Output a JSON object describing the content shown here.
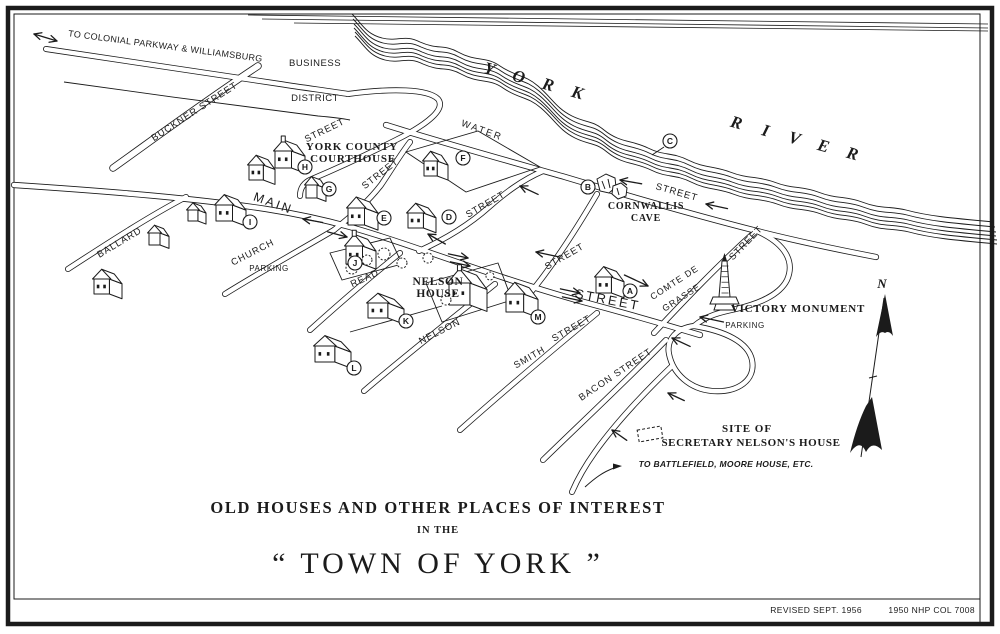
{
  "page": {
    "ink": "#1b1b1b",
    "paper": "#ffffff"
  },
  "credits": {
    "revised": "REVISED SEPT. 1956",
    "catalog": "1950  NHP  COL  7008"
  },
  "title_block": {
    "line1": "OLD HOUSES AND OTHER PLACES OF INTEREST",
    "line2": "IN THE",
    "line3": "“ TOWN OF YORK ”"
  },
  "compass": {
    "label": "N",
    "x": 882,
    "y": 288
  },
  "river": {
    "word1": "YORK",
    "w1x1": 488,
    "w1y1": 74,
    "w1x2": 576,
    "w1y2": 98,
    "word2": "RIVER",
    "w2x1": 735,
    "w2y1": 128,
    "w2x2": 851,
    "w2y2": 159,
    "rot": 16
  },
  "labels": [
    {
      "id": "to-parkway",
      "text": "TO COLONIAL PARKWAY & WILLIAMSBURG",
      "x": 165,
      "y": 49,
      "r": 7.5,
      "s": 9,
      "f": "sans",
      "sp": 0.3
    },
    {
      "id": "business",
      "text": "BUSINESS",
      "x": 315,
      "y": 66,
      "r": 0,
      "s": 9.5,
      "f": "sans",
      "sp": 0.5
    },
    {
      "id": "district",
      "text": "DISTRICT",
      "x": 315,
      "y": 101,
      "r": 0,
      "s": 9.5,
      "f": "sans",
      "sp": 0.5
    },
    {
      "id": "buckner-street",
      "text": "BUCKNER  STREET",
      "x": 196,
      "y": 114,
      "r": -33,
      "s": 9.5,
      "f": "sans",
      "sp": 1
    },
    {
      "id": "street-loop",
      "text": "STREET",
      "x": 326,
      "y": 133,
      "r": -26,
      "s": 9.5,
      "f": "sans",
      "sp": 1
    },
    {
      "id": "water-street",
      "text": "WATER",
      "x": 481,
      "y": 133,
      "r": 20,
      "s": 9.5,
      "f": "sans",
      "sp": 2
    },
    {
      "id": "york-county",
      "text": "YORK COUNTY",
      "x": 352,
      "y": 150,
      "r": 0,
      "s": 11,
      "f": "serif",
      "sp": 0.8,
      "b": true
    },
    {
      "id": "courthouse",
      "text": "COURTHOUSE",
      "x": 353,
      "y": 162,
      "r": 0,
      "s": 11,
      "f": "serif",
      "sp": 0.8,
      "b": true
    },
    {
      "id": "street-church-upper",
      "text": "STREET",
      "x": 382,
      "y": 176,
      "r": -38,
      "s": 9.5,
      "f": "sans",
      "sp": 1
    },
    {
      "id": "main-street",
      "text": "MAIN",
      "x": 272,
      "y": 207,
      "r": 20,
      "s": 12.5,
      "f": "sans",
      "sp": 2.5
    },
    {
      "id": "church-street",
      "text": "CHURCH",
      "x": 254,
      "y": 255,
      "r": -27,
      "s": 9.5,
      "f": "sans",
      "sp": 1
    },
    {
      "id": "parking-church",
      "text": "PARKING",
      "x": 269,
      "y": 271,
      "r": 0,
      "s": 8,
      "f": "sans",
      "sp": 0.6
    },
    {
      "id": "street-connector",
      "text": "STREET",
      "x": 487,
      "y": 207,
      "r": -30,
      "s": 9.5,
      "f": "sans",
      "sp": 1
    },
    {
      "id": "street-water-east",
      "text": "STREET",
      "x": 676,
      "y": 195,
      "r": 16,
      "s": 9.5,
      "f": "sans",
      "sp": 1
    },
    {
      "id": "cornwallis",
      "text": "CORNWALLIS",
      "x": 646,
      "y": 209,
      "r": 0,
      "s": 10,
      "f": "serif",
      "sp": 0.8,
      "b": true
    },
    {
      "id": "cave",
      "text": "CAVE",
      "x": 646,
      "y": 221,
      "r": 0,
      "s": 10,
      "f": "serif",
      "sp": 0.8,
      "b": true
    },
    {
      "id": "read-street",
      "text": "READ",
      "x": 366,
      "y": 281,
      "r": -25,
      "s": 9.5,
      "f": "sans",
      "sp": 1
    },
    {
      "id": "nelson-house-1",
      "text": "NELSON",
      "x": 438,
      "y": 285,
      "r": 0,
      "s": 11.5,
      "f": "serif",
      "sp": 0.6,
      "b": true
    },
    {
      "id": "nelson-house-2",
      "text": "HOUSE",
      "x": 438,
      "y": 297,
      "r": 0,
      "s": 11.5,
      "f": "serif",
      "sp": 0.6,
      "b": true
    },
    {
      "id": "nelson-street",
      "text": "NELSON",
      "x": 441,
      "y": 334,
      "r": -27,
      "s": 9.5,
      "f": "sans",
      "sp": 1
    },
    {
      "id": "street-m",
      "text": "STREET",
      "x": 566,
      "y": 259,
      "r": -30,
      "s": 9.5,
      "f": "sans",
      "sp": 1
    },
    {
      "id": "main-street-2",
      "text": "STREET",
      "x": 607,
      "y": 304,
      "r": 11,
      "s": 13,
      "f": "sans",
      "sp": 2.5
    },
    {
      "id": "smith-street",
      "text": "SMITH",
      "x": 531,
      "y": 360,
      "r": -30,
      "s": 9.5,
      "f": "sans",
      "sp": 1
    },
    {
      "id": "street-smith",
      "text": "STREET",
      "x": 573,
      "y": 331,
      "r": -30,
      "s": 9.5,
      "f": "sans",
      "sp": 1
    },
    {
      "id": "bacon-street",
      "text": "BACON  STREET",
      "x": 617,
      "y": 377,
      "r": -34,
      "s": 9.5,
      "f": "sans",
      "sp": 1
    },
    {
      "id": "comte-de",
      "text": "COMTE  DE",
      "x": 676,
      "y": 285,
      "r": -33,
      "s": 9,
      "f": "sans",
      "sp": 1
    },
    {
      "id": "grasse",
      "text": "GRASSE",
      "x": 683,
      "y": 300,
      "r": -33,
      "s": 9,
      "f": "sans",
      "sp": 1
    },
    {
      "id": "street-comte",
      "text": "STREET",
      "x": 748,
      "y": 245,
      "r": -46,
      "s": 9.5,
      "f": "sans",
      "sp": 1
    },
    {
      "id": "victory-monument",
      "text": "VICTORY  MONUMENT",
      "x": 798,
      "y": 312,
      "r": 0,
      "s": 11,
      "f": "serif",
      "sp": 0.8,
      "b": true
    },
    {
      "id": "parking-victory",
      "text": "PARKING",
      "x": 745,
      "y": 328,
      "r": 0,
      "s": 8,
      "f": "sans",
      "sp": 0.6
    },
    {
      "id": "site-of",
      "text": "SITE  OF",
      "x": 747,
      "y": 432,
      "r": 0,
      "s": 11,
      "f": "serif",
      "sp": 1,
      "b": true
    },
    {
      "id": "secretary-nelson",
      "text": "SECRETARY  NELSON'S  HOUSE",
      "x": 751,
      "y": 446,
      "r": 0,
      "s": 11,
      "f": "serif",
      "sp": 0.6,
      "b": true
    },
    {
      "id": "to-battlefield",
      "text": "TO BATTLEFIELD, MOORE HOUSE, ETC.",
      "x": 726,
      "y": 467,
      "r": 0,
      "s": 8.5,
      "f": "sans",
      "sp": 0.3,
      "b": true,
      "i": true
    },
    {
      "id": "ballard-street",
      "text": "BALLARD",
      "x": 121,
      "y": 245,
      "r": -31,
      "s": 9.5,
      "f": "sans",
      "sp": 1
    }
  ],
  "markers": [
    {
      "letter": "A",
      "x": 630,
      "y": 291
    },
    {
      "letter": "B",
      "x": 588,
      "y": 187
    },
    {
      "letter": "C",
      "x": 670,
      "y": 141
    },
    {
      "letter": "D",
      "x": 449,
      "y": 217
    },
    {
      "letter": "E",
      "x": 384,
      "y": 218
    },
    {
      "letter": "F",
      "x": 463,
      "y": 158
    },
    {
      "letter": "G",
      "x": 329,
      "y": 189
    },
    {
      "letter": "H",
      "x": 305,
      "y": 167
    },
    {
      "letter": "I",
      "x": 250,
      "y": 222
    },
    {
      "letter": "J",
      "x": 355,
      "y": 263
    },
    {
      "letter": "K",
      "x": 406,
      "y": 321
    },
    {
      "letter": "L",
      "x": 354,
      "y": 368
    },
    {
      "letter": "M",
      "x": 538,
      "y": 317
    }
  ],
  "roads": [
    {
      "id": "main-street",
      "w": 6.2,
      "d": "M14,185 C120,192 200,199 266,209 C330,219 370,232 428,252 C480,270 530,287 580,301 C625,313 660,323 700,335"
    },
    {
      "id": "water-street",
      "w": 6.2,
      "d": "M386,125 C440,142 505,160 565,177 C625,195 690,214 757,231 C800,242 840,250 876,257"
    },
    {
      "id": "parkway",
      "w": 6,
      "d": "M46,49 C120,60 200,72 280,84 C305,88 330,91 348,94"
    },
    {
      "id": "business-loop",
      "w": 6,
      "d": "M348,94 C392,88 428,89 438,99 C446,109 428,124 396,140 C368,154 338,168 312,179 C302,183 300,190 300,196"
    },
    {
      "id": "buckner-road",
      "w": 7.5,
      "d": "M113,168 C155,138 205,101 258,66"
    },
    {
      "id": "ballard-road",
      "w": 6,
      "d": "M68,269 C108,243 148,217 186,197"
    },
    {
      "id": "church-lower",
      "w": 6,
      "d": "M225,294 C262,271 300,250 334,230"
    },
    {
      "id": "church-upper",
      "w": 6,
      "d": "M334,230 C352,216 368,202 381,185 C390,172 398,158 410,142"
    },
    {
      "id": "read-road",
      "w": 6,
      "d": "M310,330 C340,303 370,277 400,253"
    },
    {
      "id": "nelson-road",
      "w": 6,
      "d": "M364,391 C400,360 448,322 495,284"
    },
    {
      "id": "smith-road",
      "w": 6,
      "d": "M460,430 C505,390 550,352 597,313"
    },
    {
      "id": "bacon-road",
      "w": 6,
      "d": "M543,460 C580,424 625,382 666,340"
    },
    {
      "id": "comte-road",
      "w": 6,
      "d": "M654,333 C684,301 718,265 756,231"
    },
    {
      "id": "m-water-connector",
      "w": 6,
      "d": "M527,297 C548,272 570,240 597,194"
    },
    {
      "id": "main-water-connector",
      "w": 6,
      "d": "M419,251 C448,238 470,224 489,207 C505,193 522,180 543,171"
    },
    {
      "id": "water-loop-spur",
      "w": 6,
      "d": "M757,231 C786,244 795,262 787,280 C779,296 757,304 736,309 C722,312 707,315 694,326"
    },
    {
      "id": "turn-loop",
      "w": 6,
      "d": "M694,326 C725,331 748,342 752,360 C756,380 738,393 712,391 C690,389 673,374 669,354 C666,339 677,328 694,326 Z"
    },
    {
      "id": "battlefield-exit",
      "w": 6,
      "d": "M672,366 C645,392 615,424 595,452 C585,466 578,478 572,492"
    }
  ],
  "road_lines": [
    {
      "id": "parkway-lower-edge",
      "d": "M64,82 C150,94 230,105 318,116 C330,117 340,118 350,120"
    }
  ],
  "blocks": [
    {
      "id": "courthouse-block",
      "d": "M406,152 L478,131 L540,167 L466,192 Z"
    },
    {
      "id": "j-lot",
      "d": "M330,253 L390,238 L402,264 L342,280 Z"
    },
    {
      "id": "nelson-lot",
      "d": "M426,283 L498,263 L512,300 L442,322 Z"
    },
    {
      "id": "k-lot-line",
      "d": "M350,332 L442,306"
    }
  ],
  "shoreline": {
    "base": "M352,14 C362,24 366,34 382,38 C398,42 404,34 420,42 C438,50 444,44 458,52 C476,62 486,56 500,66 C516,77 524,74 538,86 C552,98 556,108 572,116 C586,123 592,120 604,130 C620,143 632,140 648,148 C664,156 672,152 688,160 C704,168 714,166 730,172 C748,179 758,176 774,182 C792,189 802,186 818,192 C836,199 846,196 862,202 C880,209 890,206 906,210 C928,216 950,218 994,222",
    "offsets": [
      [
        0,
        0
      ],
      [
        1,
        5
      ],
      [
        2,
        10
      ],
      [
        2,
        14
      ],
      [
        3,
        18
      ],
      [
        3,
        22
      ]
    ],
    "far_edge": [
      "M248,15 C400,18 600,20 988,24",
      "M262,19 C420,22 620,24 988,28",
      "M294,23 C460,26 660,28 988,31"
    ]
  },
  "buildings": [
    {
      "id": "house-west-1",
      "x": 108,
      "y": 294,
      "w": 28,
      "h": 15
    },
    {
      "id": "house-west-2",
      "x": 159,
      "y": 245,
      "w": 20,
      "h": 12
    },
    {
      "id": "house-west-3",
      "x": 197,
      "y": 221,
      "w": 18,
      "h": 11
    },
    {
      "id": "i-house",
      "x": 231,
      "y": 221,
      "w": 30,
      "h": 16
    },
    {
      "id": "courthouse-wing",
      "x": 262,
      "y": 180,
      "w": 26,
      "h": 15
    },
    {
      "id": "courthouse-main",
      "x": 290,
      "y": 168,
      "w": 30,
      "h": 17,
      "c": true
    },
    {
      "id": "g-house",
      "x": 316,
      "y": 198,
      "w": 20,
      "h": 13
    },
    {
      "id": "e-house",
      "x": 363,
      "y": 225,
      "w": 30,
      "h": 17
    },
    {
      "id": "d-house",
      "x": 422,
      "y": 228,
      "w": 28,
      "h": 15
    },
    {
      "id": "f-house",
      "x": 436,
      "y": 176,
      "w": 24,
      "h": 15
    },
    {
      "id": "j-house",
      "x": 361,
      "y": 264,
      "w": 30,
      "h": 18,
      "c": true
    },
    {
      "id": "nelson-house",
      "x": 468,
      "y": 305,
      "w": 38,
      "h": 22,
      "c": true
    },
    {
      "id": "k-house",
      "x": 386,
      "y": 318,
      "w": 36,
      "h": 15
    },
    {
      "id": "l-house",
      "x": 333,
      "y": 362,
      "w": 36,
      "h": 16
    },
    {
      "id": "m-house",
      "x": 522,
      "y": 312,
      "w": 32,
      "h": 18
    },
    {
      "id": "a-house",
      "x": 610,
      "y": 293,
      "w": 28,
      "h": 16
    }
  ],
  "trees": [
    {
      "x": 352,
      "y": 268,
      "r": 6
    },
    {
      "x": 367,
      "y": 260,
      "r": 5
    },
    {
      "x": 384,
      "y": 254,
      "r": 6
    },
    {
      "x": 402,
      "y": 263,
      "r": 5
    },
    {
      "x": 428,
      "y": 258,
      "r": 5
    },
    {
      "x": 446,
      "y": 300,
      "r": 5
    },
    {
      "x": 490,
      "y": 276,
      "r": 4
    }
  ],
  "arrows": [
    {
      "id": "parkway-two-way",
      "x": 34,
      "y": 34,
      "a": 197,
      "len": 24,
      "double": true
    },
    {
      "id": "main-church-left",
      "x": 303,
      "y": 219,
      "a": 190,
      "len": 20
    },
    {
      "id": "main-church-right",
      "x": 347,
      "y": 237,
      "a": 15,
      "len": 20
    },
    {
      "id": "main-int-left",
      "x": 536,
      "y": 252,
      "a": 192,
      "len": 24
    },
    {
      "id": "main-int-curve",
      "x": 648,
      "y": 286,
      "a": 25,
      "len": 26
    },
    {
      "id": "main-one-way-1a",
      "x": 468,
      "y": 258,
      "a": 12,
      "len": 20
    },
    {
      "id": "main-one-way-1b",
      "x": 470,
      "y": 266,
      "a": 12,
      "len": 20
    },
    {
      "id": "main-one-way-2a",
      "x": 580,
      "y": 293,
      "a": 12,
      "len": 20
    },
    {
      "id": "main-one-way-2b",
      "x": 582,
      "y": 301,
      "a": 12,
      "len": 20
    },
    {
      "id": "water-b-left",
      "x": 620,
      "y": 180,
      "a": 190,
      "len": 22
    },
    {
      "id": "water-east-left",
      "x": 706,
      "y": 204,
      "a": 192,
      "len": 22
    },
    {
      "id": "connector-down",
      "x": 428,
      "y": 234,
      "a": 210,
      "len": 20
    },
    {
      "id": "connector-up",
      "x": 520,
      "y": 186,
      "a": 205,
      "len": 20
    },
    {
      "id": "loop-parking",
      "x": 700,
      "y": 317,
      "a": 192,
      "len": 24
    },
    {
      "id": "loop-top",
      "x": 672,
      "y": 338,
      "a": 205,
      "len": 20
    },
    {
      "id": "loop-bottom",
      "x": 668,
      "y": 393,
      "a": 205,
      "len": 18
    },
    {
      "id": "exit-sw",
      "x": 612,
      "y": 430,
      "a": 215,
      "len": 18
    }
  ],
  "battlefield_arrow": {
    "tail": "M585,487 C595,478 603,472 614,468",
    "tipx": 622,
    "tipy": 466
  },
  "monument": {
    "shaft": "722,261 727,261 730,297 719,297",
    "finial": "722,261 727,261 724.5,253",
    "base1": "713,297 736,297 739,304 710,304",
    "base2": "716,304 733,304 735,310 714,310"
  },
  "cave_paths": [
    "M597,179 l9,-5 l9,4 l1,9 l-7,6 l-9,-2 Z",
    "M613,186 l8,-3 l6,5 l-1,8 l-8,3 l-6,-5 Z",
    "M602,181 l3,8",
    "M608,179 l2,9",
    "M617,188 l2,7"
  ],
  "site_box": {
    "x": 638,
    "y": 428,
    "w": 24,
    "h": 12,
    "rot": -10
  },
  "c_leader": "M664,147 L652,155",
  "frame": {
    "outer": [
      8,
      8,
      984,
      616
    ],
    "inner": [
      14,
      14,
      966,
      585
    ],
    "divider": "M980,599 L980,622"
  }
}
